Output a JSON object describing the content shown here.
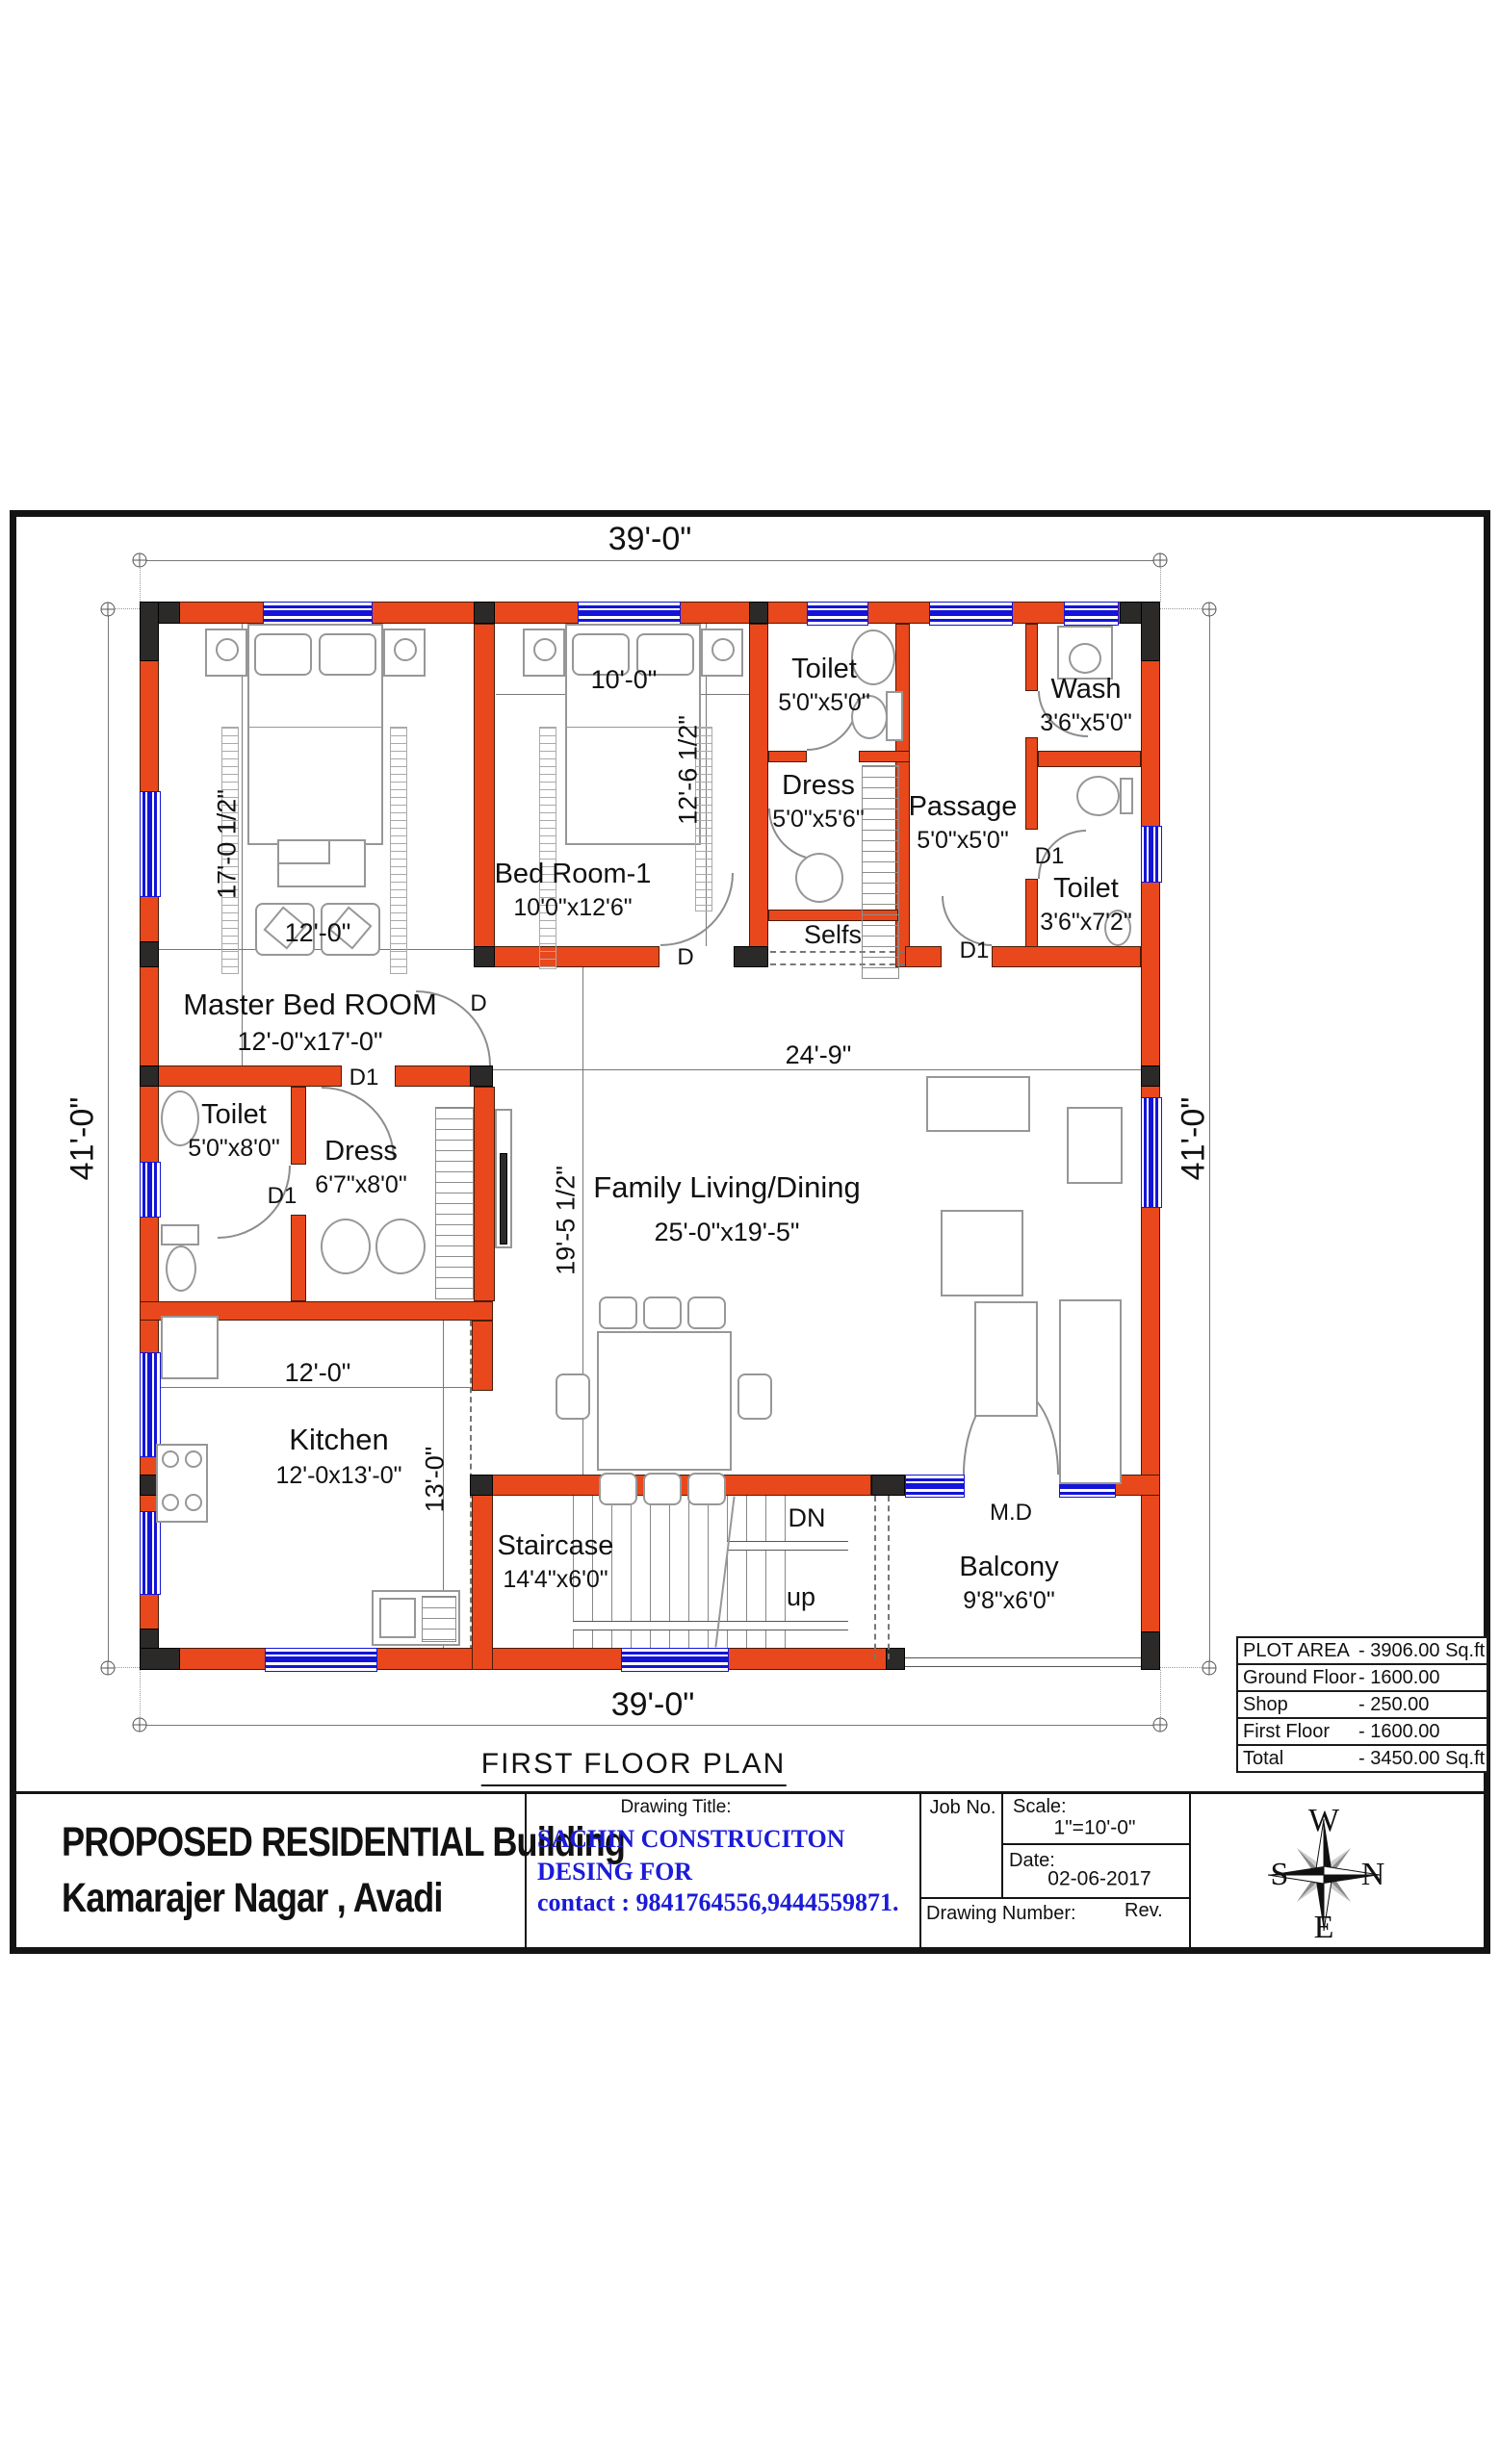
{
  "colors": {
    "wall": "#e8481c",
    "wall_corner": "#2b2a28",
    "window": "#1414d8",
    "firm_text": "#1b1bd8"
  },
  "plan_title": "FIRST  FLOOR PLAN",
  "dims": {
    "top_width": "39'-0\"",
    "bottom_width": "39'-0\"",
    "left_height": "41'-0\"",
    "right_height": "41'-0\"",
    "master_width": "12'-0\"",
    "master_height": "17'-0 1/2\"",
    "bed1_width": "10'-0\"",
    "bed1_height": "12'-6 1/2\"",
    "living_width": "24'-9\"",
    "living_height": "19'-5 1/2\"",
    "kitchen_width": "12'-0\"",
    "kitchen_height": "13'-0\""
  },
  "rooms": {
    "toilet_top": {
      "name": "Toilet",
      "size": "5'0\"x5'0\""
    },
    "wash": {
      "name": "Wash",
      "size": "3'6\"x5'0\""
    },
    "dress_top": {
      "name": "Dress",
      "size": "5'0\"x5'6\""
    },
    "passage": {
      "name": "Passage",
      "size": "5'0\"x5'0\""
    },
    "toilet_right": {
      "name": "Toilet",
      "size": "3'6\"x7'2\""
    },
    "bedroom1": {
      "name": "Bed Room-1",
      "size": "10'0\"x12'6\""
    },
    "master": {
      "name": "Master Bed ROOM",
      "size": "12'-0\"x17'-0\""
    },
    "toilet_left": {
      "name": "Toilet",
      "size": "5'0\"x8'0\""
    },
    "dress_left": {
      "name": "Dress",
      "size": "6'7\"x8'0\""
    },
    "living": {
      "name": "Family Living/Dining",
      "size": "25'-0\"x19'-5\""
    },
    "kitchen": {
      "name": "Kitchen",
      "size": "12'-0x13'-0\""
    },
    "staircase": {
      "name": "Staircase",
      "size": "14'4\"x6'0\""
    },
    "balcony": {
      "name": "Balcony",
      "size": "9'8\"x6'0\""
    },
    "selfs": "Selfs"
  },
  "door_labels": {
    "d": "D",
    "d1": "D1",
    "md": "M.D",
    "dn": "DN",
    "up": "up"
  },
  "area_table": {
    "rows": [
      {
        "label": "PLOT AREA",
        "value": "- 3906.00 Sq.ft"
      },
      {
        "label": "Ground Floor",
        "value": "- 1600.00"
      },
      {
        "label": "Shop",
        "value": "-   250.00"
      },
      {
        "label": "First  Floor",
        "value": "- 1600.00"
      },
      {
        "label": "Total",
        "value": "- 3450.00 Sq.ft"
      }
    ]
  },
  "title_block": {
    "project_line1": "PROPOSED RESIDENTIAL Building",
    "project_line2": "Kamarajer Nagar , Avadi",
    "drawing_title_label": "Drawing Title:",
    "firm_line1": "SACHIN CONSTRUCITON",
    "firm_line2": "DESING FOR",
    "firm_line3": "contact : 9841764556,9444559871.",
    "job_no_label": "Job No.",
    "scale_label": "Scale:",
    "scale_value": "1\"=10'-0\"",
    "date_label": "Date:",
    "date_value": "02-06-2017",
    "drawing_number_label": "Drawing Number:",
    "rev_label": "Rev.",
    "compass": {
      "top": "W",
      "left": "S",
      "right": "N",
      "bottom": "E"
    }
  }
}
